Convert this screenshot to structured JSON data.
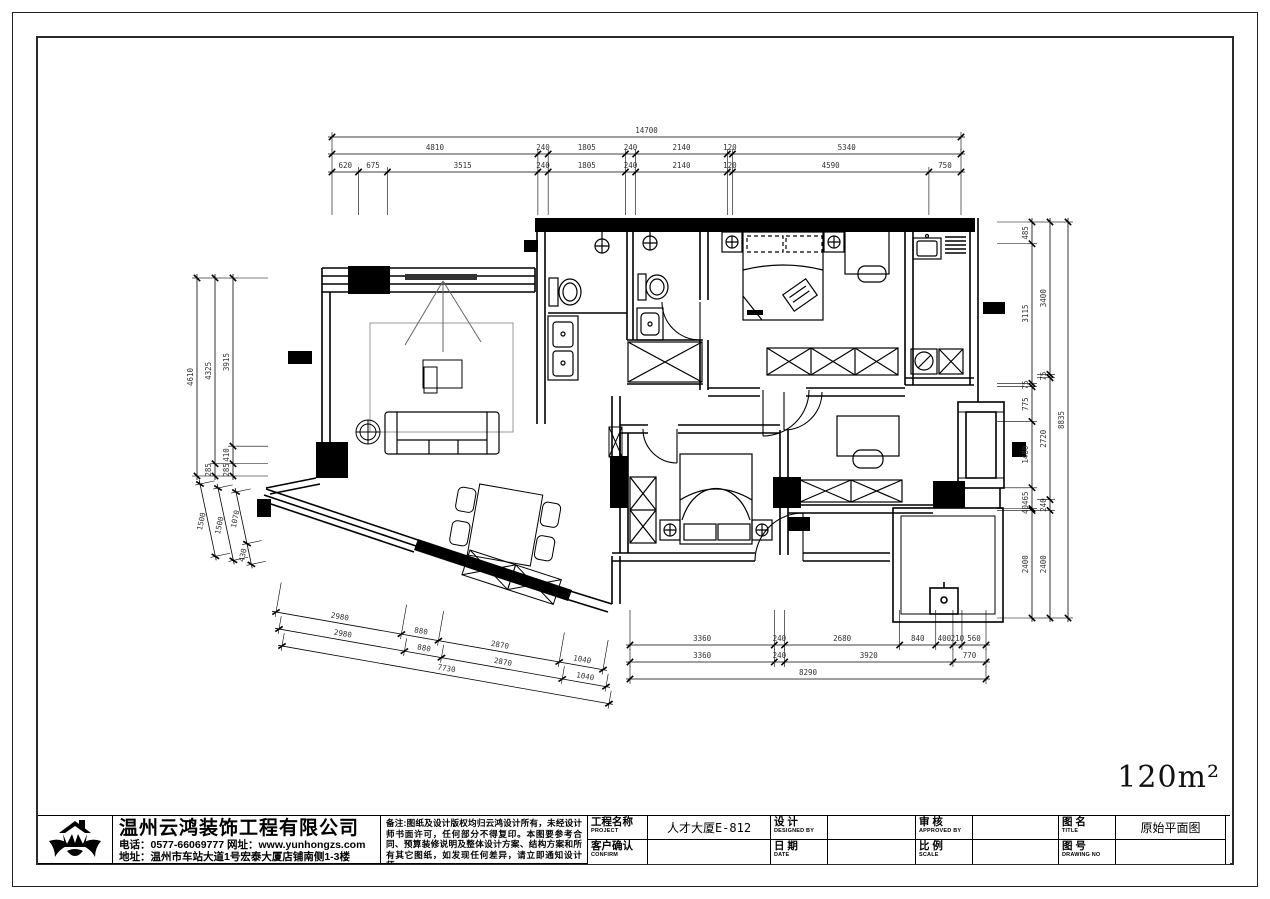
{
  "meta": {
    "area_label": "120m²"
  },
  "title_block": {
    "company": {
      "name": "温州云鸿装饰工程有限公司",
      "phone_line": "电话：0577-66069777 网址：www.yunhongzs.com",
      "address_line": "地址：温州市车站大道1号宏泰大厦店铺南侧1-3楼"
    },
    "notes": "备注:图纸及设计版权均归云鸿设计所有，未经设计师书面许可，任何部分不得复印。本图要参考合同、预算装修说明及整体设计方案、结构方案和所有其它图纸，如发现任何差异，请立即通知设计师。",
    "fields": [
      {
        "label": "工程名称",
        "sub": "PROJECT",
        "value": "人才大厦E-812"
      },
      {
        "label": "设  计",
        "sub": "DESIGNED BY",
        "value": ""
      },
      {
        "label": "审  核",
        "sub": "APPROVED BY",
        "value": ""
      },
      {
        "label": "图  名",
        "sub": "TITLE",
        "value": "原始平面图"
      },
      {
        "label": "客户确认",
        "sub": "CONFIRM",
        "value": ""
      },
      {
        "label": "日  期",
        "sub": "DATE",
        "value": ""
      },
      {
        "label": "比  例",
        "sub": "SCALE",
        "value": ""
      },
      {
        "label": "图  号",
        "sub": "DRAWING NO",
        "value": ""
      }
    ]
  },
  "dimensions": {
    "groups": [
      {
        "id": "top-total",
        "x": 332,
        "y": 137,
        "angle": 0,
        "length": 629,
        "toff": 6,
        "trot": 0,
        "ext": 8,
        "extdir": -1,
        "values": [
          14700
        ]
      },
      {
        "id": "top-row2",
        "x": 332,
        "y": 154,
        "angle": 0,
        "length": 629,
        "toff": 6,
        "trot": 0,
        "ext": 8,
        "extdir": -1,
        "values": [
          4810,
          240,
          1805,
          240,
          2140,
          120,
          5340
        ]
      },
      {
        "id": "top-row3",
        "x": 332,
        "y": 172,
        "angle": 0,
        "length": 629,
        "toff": 6,
        "trot": 0,
        "ext": 38,
        "extdir": -1,
        "values": [
          620,
          675,
          3515,
          240,
          1805,
          240,
          2140,
          120,
          4590,
          750
        ]
      },
      {
        "id": "left-col1",
        "x": 197,
        "y": 278,
        "angle": 90,
        "length": 198,
        "toff": -6,
        "trot": -90,
        "ext": 8,
        "extdir": 1,
        "values": [
          4610
        ]
      },
      {
        "id": "left-col2",
        "x": 215,
        "y": 278,
        "angle": 90,
        "length": 198,
        "toff": -6,
        "trot": -90,
        "ext": 8,
        "extdir": 1,
        "values": [
          4325,
          285
        ]
      },
      {
        "id": "left-col3",
        "x": 233,
        "y": 278,
        "angle": 90,
        "length": 198,
        "toff": -6,
        "trot": -90,
        "ext": 30,
        "extdir": 1,
        "values": [
          3915,
          410,
          285
        ]
      },
      {
        "id": "left-lower1",
        "x": 200,
        "y": 484,
        "angle": 78,
        "length": 74,
        "toff": -6,
        "trot": -78,
        "ext": 10,
        "extdir": 1,
        "values": [
          1500
        ]
      },
      {
        "id": "left-lower2",
        "x": 218,
        "y": 488,
        "angle": 78,
        "length": 74,
        "toff": -6,
        "trot": -78,
        "ext": 10,
        "extdir": 1,
        "values": [
          1500
        ]
      },
      {
        "id": "left-lower3",
        "x": 236,
        "y": 492,
        "angle": 78,
        "length": 74,
        "toff": -6,
        "trot": -78,
        "ext": 10,
        "extdir": 1,
        "values": [
          1070,
          430
        ]
      },
      {
        "id": "right-col1",
        "x": 1032,
        "y": 222,
        "angle": 90,
        "length": 396,
        "toff": -6,
        "trot": -90,
        "ext": 30,
        "extdir": -1,
        "values": [
          485,
          3115,
          75,
          775,
          1480,
          465,
          40,
          2400
        ]
      },
      {
        "id": "right-col2",
        "x": 1050,
        "y": 222,
        "angle": 90,
        "length": 396,
        "toff": -6,
        "trot": -90,
        "ext": 8,
        "extdir": -1,
        "values": [
          3400,
          75,
          2720,
          240,
          2400
        ]
      },
      {
        "id": "right-col3",
        "x": 1068,
        "y": 222,
        "angle": 90,
        "length": 396,
        "toff": -6,
        "trot": -90,
        "ext": 8,
        "extdir": -1,
        "values": [
          8835
        ]
      },
      {
        "id": "bottom-left1",
        "x": 276,
        "y": 612,
        "angle": 10,
        "length": 332,
        "toff": 6,
        "trot": 10,
        "ext": 25,
        "extdir": 1,
        "values": [
          2980,
          880,
          2870,
          1040
        ]
      },
      {
        "id": "bottom-left2",
        "x": 279,
        "y": 629,
        "angle": 10,
        "length": 332,
        "toff": 6,
        "trot": 10,
        "ext": 8,
        "extdir": 1,
        "values": [
          2980,
          880,
          2870,
          1040
        ]
      },
      {
        "id": "bottom-left3",
        "x": 282,
        "y": 646,
        "angle": 10,
        "length": 332,
        "toff": 6,
        "trot": 10,
        "ext": 8,
        "extdir": 1,
        "values": [
          7730
        ]
      },
      {
        "id": "bottom-mid1",
        "x": 630,
        "y": 645,
        "angle": 0,
        "length": 356,
        "toff": 6,
        "trot": 0,
        "ext": 30,
        "extdir": 1,
        "values": [
          3360,
          240,
          2680,
          840,
          400,
          210,
          560
        ]
      },
      {
        "id": "bottom-mid2",
        "x": 630,
        "y": 662,
        "angle": 0,
        "length": 356,
        "toff": 6,
        "trot": 0,
        "ext": 8,
        "extdir": 1,
        "values": [
          3360,
          240,
          3920,
          770
        ]
      },
      {
        "id": "bottom-mid3",
        "x": 630,
        "y": 679,
        "angle": 0,
        "length": 356,
        "toff": 6,
        "trot": 0,
        "ext": 8,
        "extdir": 1,
        "values": [
          8290
        ]
      }
    ]
  }
}
